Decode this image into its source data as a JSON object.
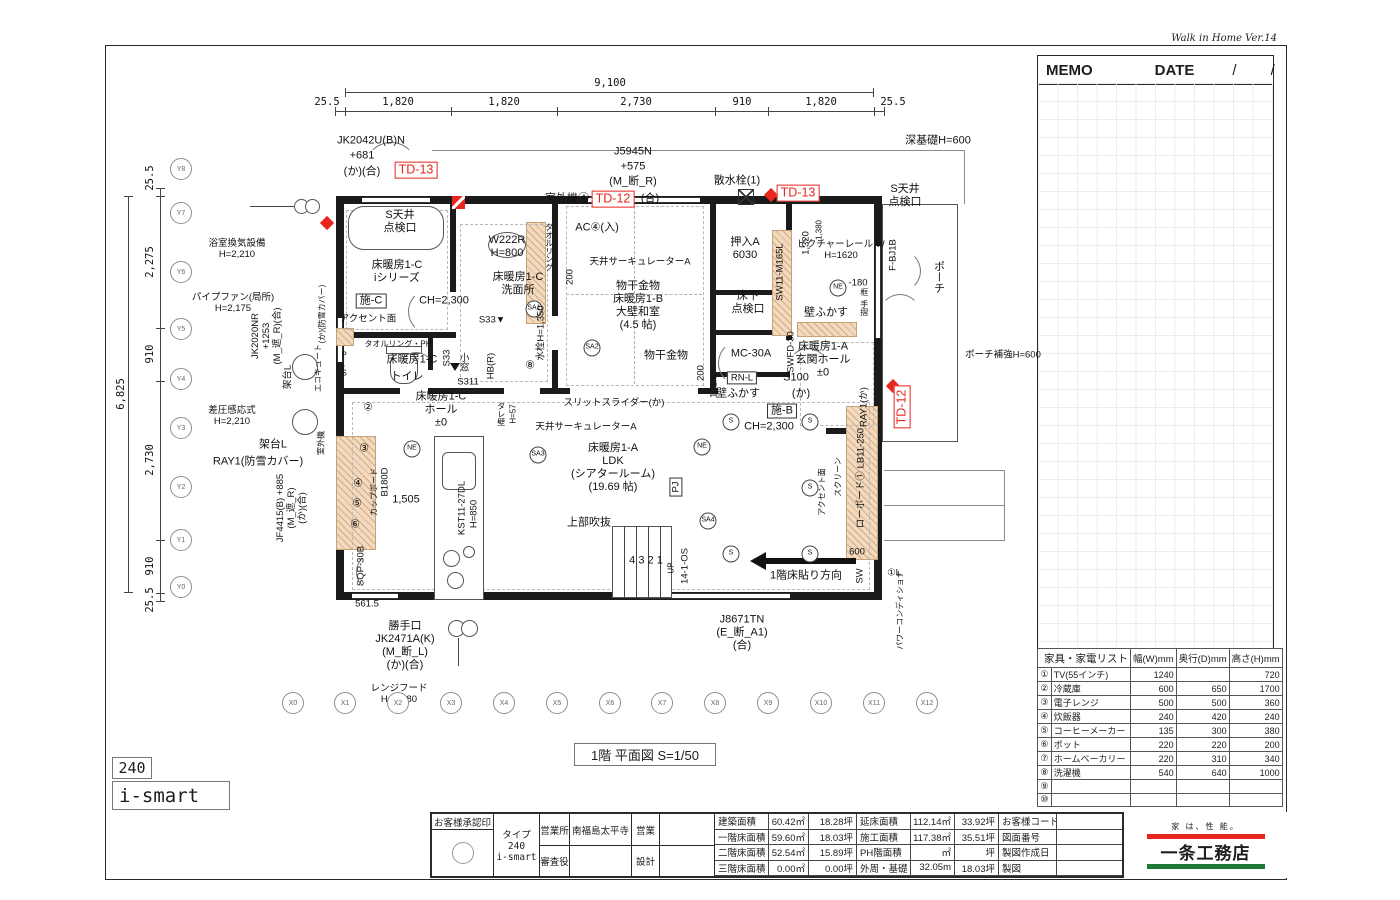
{
  "app": {
    "version_label": "Walk in Home Ver.14"
  },
  "memo": {
    "memo_label": "MEMO",
    "date_label": "DATE",
    "slash1": "/",
    "slash2": "/"
  },
  "plan": {
    "title": "1階  平面図 S=1/50",
    "type_badge": "240",
    "model_badge": "i-smart",
    "annotations": [
      [
        "JK2042U(B)N",
        371,
        141,
        ""
      ],
      [
        "+681",
        362,
        156,
        ""
      ],
      [
        "(か)(合)",
        362,
        172,
        ""
      ],
      [
        "TD-13",
        416,
        170,
        "red box"
      ],
      [
        "室外機④",
        567,
        199,
        ""
      ],
      [
        "TD-12",
        613,
        199,
        "red box"
      ],
      [
        "(合)",
        650,
        199,
        ""
      ],
      [
        "J5945N",
        633,
        152,
        ""
      ],
      [
        "+575",
        633,
        167,
        ""
      ],
      [
        "(M_断_R)",
        633,
        182,
        ""
      ],
      [
        "散水栓(1)",
        737,
        181,
        ""
      ],
      [
        "TD-13",
        798,
        193,
        "red box"
      ],
      [
        "S天井\n点検口",
        905,
        196,
        ""
      ],
      [
        "深基礎H=600",
        938,
        141,
        ""
      ],
      [
        "浴室換気設備\nH=2,210",
        237,
        249,
        "sm"
      ],
      [
        "パイプファン(局所)\nH=2,175",
        233,
        303,
        "sm"
      ],
      [
        "JK2020NR\n+1253\n(M_遮_R)(合)",
        267,
        336,
        "rot sm"
      ],
      [
        "(か)(防雪カバー)",
        322,
        314,
        "rot tiny"
      ],
      [
        "エコキュート",
        318,
        368,
        "rot tiny"
      ],
      [
        "架台L",
        288,
        377,
        "rot sm"
      ],
      [
        "差圧感応式\nH=2,210",
        232,
        416,
        "sm"
      ],
      [
        "架台L",
        273,
        445,
        ""
      ],
      [
        "室外機",
        321,
        443,
        "rot tiny"
      ],
      [
        "RAY1(防雪カバー)",
        258,
        462,
        ""
      ],
      [
        "JF4415(B) +885\n(M_遮_R)\n(か)(合)",
        292,
        508,
        "rot sm"
      ],
      [
        "S天井\n点検口",
        400,
        222,
        ""
      ],
      [
        "床暖房1-C\niシリーズ",
        397,
        272,
        ""
      ],
      [
        "施-C",
        371,
        301,
        "box"
      ],
      [
        "アクセント面",
        368,
        319,
        "sm"
      ],
      [
        "CH=2,300",
        444,
        301,
        ""
      ],
      [
        "W222R\nH=800",
        507,
        247,
        ""
      ],
      [
        "タオルリング",
        549,
        247,
        "vert tiny"
      ],
      [
        "床暖房1-C\n洗面所",
        518,
        284,
        ""
      ],
      [
        "SA1",
        534,
        309,
        "circ"
      ],
      [
        "S33▼",
        492,
        320,
        "sm"
      ],
      [
        "水栓H=1,350",
        541,
        333,
        "rot sm"
      ],
      [
        "⑧",
        530,
        366,
        ""
      ],
      [
        "タオルリング・PH",
        398,
        344,
        "tiny"
      ],
      [
        "P.S",
        344,
        364,
        "vert tiny"
      ],
      [
        "床暖房1-C",
        412,
        360,
        ""
      ],
      [
        "トイレ",
        407,
        377,
        ""
      ],
      [
        "S33",
        447,
        358,
        "rot sm"
      ],
      [
        "小窓",
        463,
        362,
        "vert sm"
      ],
      [
        "S311",
        468,
        382,
        "sm"
      ],
      [
        "HB(R)",
        491,
        366,
        "rot sm"
      ],
      [
        "AC④(入)",
        597,
        228,
        ""
      ],
      [
        "天井サーキュレーターA",
        640,
        262,
        "sm"
      ],
      [
        "200",
        570,
        277,
        "rot sm"
      ],
      [
        "物干金物\n床暖房1-B\n大壁和室\n(4.5 帖)",
        638,
        306,
        ""
      ],
      [
        "SA2",
        592,
        348,
        "circ"
      ],
      [
        "物干金物",
        666,
        356,
        ""
      ],
      [
        "200",
        701,
        373,
        "rot sm"
      ],
      [
        "押入A\n6030",
        745,
        249,
        ""
      ],
      [
        "床下\n点検口",
        748,
        303,
        ""
      ],
      [
        "SW11-M165L",
        780,
        272,
        "rot sm"
      ],
      [
        "MC-30A",
        751,
        354,
        ""
      ],
      [
        "1,320",
        806,
        243,
        "rot sm"
      ],
      [
        "1,380",
        819,
        230,
        "rot tiny"
      ],
      [
        "ピクチャーレール W\nH=1620",
        841,
        250,
        "sm"
      ],
      [
        "NE",
        838,
        288,
        "circ"
      ],
      [
        "-180",
        858,
        283,
        "sm"
      ],
      [
        "框",
        864,
        292,
        "vert tiny"
      ],
      [
        "手摺",
        864,
        308,
        "vert tiny"
      ],
      [
        "壁ふかす",
        826,
        313,
        ""
      ],
      [
        "床暖房1-A\n玄関ホール\n±0",
        823,
        360,
        ""
      ],
      [
        "SWFD-30",
        791,
        352,
        "rot sm"
      ],
      [
        "F-BJ1B",
        893,
        255,
        "rot sm"
      ],
      [
        "ポーチ",
        938,
        277,
        "vert"
      ],
      [
        "ポーチ補強H=600",
        1003,
        355,
        "sm"
      ],
      [
        "RN-L",
        742,
        378,
        "box sm"
      ],
      [
        "壁ふかす",
        738,
        394,
        ""
      ],
      [
        "101.5",
        714,
        386,
        "rot sm"
      ],
      [
        "S100",
        796,
        378,
        ""
      ],
      [
        "(か)",
        801,
        394,
        ""
      ],
      [
        "施-B",
        782,
        411,
        "box"
      ],
      [
        "CH=2,300",
        769,
        427,
        ""
      ],
      [
        "スリットスライダー(か)",
        614,
        403,
        "sm"
      ],
      [
        "天井サーキュレーターA",
        586,
        427,
        "sm"
      ],
      [
        "床暖房1-A\nLDK\n(シアタールーム)\n(19.69 帖)",
        613,
        468,
        ""
      ],
      [
        "PJ",
        676,
        487,
        "box rot sm"
      ],
      [
        "NE",
        702,
        447,
        "circ"
      ],
      [
        "SA3",
        538,
        455,
        "circ"
      ],
      [
        "SA4",
        708,
        521,
        "circ"
      ],
      [
        "S",
        731,
        422,
        "circ"
      ],
      [
        "S",
        810,
        422,
        "circ"
      ],
      [
        "S",
        810,
        488,
        "circ"
      ],
      [
        "S",
        731,
        554,
        "circ"
      ],
      [
        "S",
        810,
        554,
        "circ"
      ],
      [
        "上部吹抜",
        589,
        523,
        ""
      ],
      [
        "4 3 2 1",
        646,
        561,
        ""
      ],
      [
        "UP",
        671,
        568,
        "rot tiny"
      ],
      [
        "14-1-OS",
        685,
        566,
        "rot sm"
      ],
      [
        "1階床貼り方向",
        806,
        576,
        ""
      ],
      [
        "床暖房1-C\nホール\n±0",
        441,
        410,
        ""
      ],
      [
        "②",
        368,
        408,
        ""
      ],
      [
        "③",
        364,
        449,
        ""
      ],
      [
        "④",
        358,
        484,
        ""
      ],
      [
        "⑤",
        357,
        504,
        ""
      ],
      [
        "⑥",
        355,
        525,
        ""
      ],
      [
        "カップボード",
        374,
        492,
        "rot tiny"
      ],
      [
        "B180D",
        385,
        482,
        "rot sm"
      ],
      [
        "1,505",
        406,
        500,
        ""
      ],
      [
        "NE",
        412,
        449,
        "circ"
      ],
      [
        "KST11-27DL",
        462,
        508,
        "rot sm"
      ],
      [
        "H=850",
        474,
        514,
        "rot sm"
      ],
      [
        "タレ壁",
        501,
        414,
        "vert tiny"
      ],
      [
        "H=57",
        513,
        414,
        "rot tiny"
      ],
      [
        "SQP-30B",
        361,
        566,
        "rot sm"
      ],
      [
        "561.5",
        367,
        604,
        "sm"
      ],
      [
        "RAY1(か)",
        864,
        407,
        "rot sm"
      ],
      [
        "スクリーン",
        838,
        477,
        "rot tiny"
      ],
      [
        "アクセント面",
        822,
        492,
        "rot tiny"
      ],
      [
        "ローボード① LB11-250",
        861,
        478,
        "rot sm"
      ],
      [
        "600",
        857,
        552,
        "sm"
      ],
      [
        "SW",
        860,
        576,
        "rot sm"
      ],
      [
        "TD-12",
        902,
        407,
        "red box rot"
      ],
      [
        "①L",
        894,
        573,
        "sm"
      ],
      [
        "パワーコンディショナ",
        900,
        610,
        "rot tiny"
      ],
      [
        "勝手口\nJK2471A(K)\n(M_断_L)\n(か)(合)",
        405,
        646,
        ""
      ],
      [
        "レンジフード\nH=2,280",
        399,
        694,
        "sm"
      ],
      [
        "J8671TN\n(E_断_A1)\n(合)",
        742,
        633,
        ""
      ]
    ],
    "grid": {
      "x_row_y": 703,
      "x": [
        [
          "X0",
          293
        ],
        [
          "X1",
          345
        ],
        [
          "X2",
          398
        ],
        [
          "X3",
          451
        ],
        [
          "X4",
          504
        ],
        [
          "X5",
          557
        ],
        [
          "X6",
          610
        ],
        [
          "X7",
          662
        ],
        [
          "X8",
          715
        ],
        [
          "X9",
          768
        ],
        [
          "X10",
          821
        ],
        [
          "X11",
          874
        ],
        [
          "X12",
          927
        ]
      ],
      "y_col_x": 181,
      "y": [
        [
          "Y8",
          169
        ],
        [
          "Y7",
          213
        ],
        [
          "Y6",
          272
        ],
        [
          "Y5",
          329
        ],
        [
          "Y4",
          379
        ],
        [
          "Y3",
          428
        ],
        [
          "Y2",
          487
        ],
        [
          "Y1",
          540
        ],
        [
          "Y0",
          587
        ]
      ]
    },
    "dims": {
      "top_total": "9,100",
      "top_ticks": [
        335,
        345,
        451,
        557,
        715,
        768,
        874,
        884
      ],
      "top_labels": [
        [
          "25.5",
          327
        ],
        [
          "1,820",
          398
        ],
        [
          "1,820",
          504
        ],
        [
          "2,730",
          636
        ],
        [
          "910",
          742
        ],
        [
          "1,820",
          821
        ],
        [
          "25.5",
          893
        ]
      ],
      "left_total": "6,825",
      "left_ticks": [
        188,
        196,
        328,
        381,
        540,
        593,
        601
      ],
      "left_labels": [
        [
          "25.5",
          178
        ],
        [
          "2,275",
          262
        ],
        [
          "910",
          354
        ],
        [
          "2,730",
          460
        ],
        [
          "910",
          566
        ],
        [
          "25.5",
          600
        ]
      ]
    }
  },
  "furniture": {
    "title": "家具・家電リスト",
    "cols": [
      "幅(W)mm",
      "奥行(D)mm",
      "高さ(H)mm"
    ],
    "rows": [
      [
        "①",
        "TV(55インチ)",
        "1240",
        "",
        "720"
      ],
      [
        "②",
        "冷蔵庫",
        "600",
        "650",
        "1700"
      ],
      [
        "③",
        "電子レンジ",
        "500",
        "500",
        "360"
      ],
      [
        "④",
        "炊飯器",
        "240",
        "420",
        "240"
      ],
      [
        "⑤",
        "コーヒーメーカー",
        "135",
        "300",
        "380"
      ],
      [
        "⑥",
        "ポット",
        "220",
        "220",
        "200"
      ],
      [
        "⑦",
        "ホームベーカリー",
        "220",
        "310",
        "340"
      ],
      [
        "⑧",
        "洗濯機",
        "540",
        "640",
        "1000"
      ],
      [
        "⑨",
        "",
        "",
        "",
        ""
      ],
      [
        "⑩",
        "",
        "",
        "",
        ""
      ]
    ]
  },
  "title_block": {
    "approval_label": "お客様承認印",
    "type_label": "タイプ",
    "type_value": "240",
    "model_value": "i-smart",
    "office_label": "営業所",
    "office_value": "南福島太平寺",
    "examiner_label": "審査役",
    "examiner_value": "",
    "sales_label": "営業",
    "sales_value": "",
    "design_label": "設計",
    "design_value": "",
    "areas_a": [
      [
        "建築面積",
        "60.42㎡",
        "18.28坪"
      ],
      [
        "一階床面積",
        "59.60㎡",
        "18.03坪"
      ],
      [
        "二階床面積",
        "52.54㎡",
        "15.89坪"
      ],
      [
        "三階床面積",
        "0.00㎡",
        "0.00坪"
      ]
    ],
    "areas_b": [
      [
        "延床面積",
        "112.14㎡",
        "33.92坪"
      ],
      [
        "施工面積",
        "117.38㎡",
        "35.51坪"
      ],
      [
        "PH階面積",
        "㎡",
        "坪"
      ],
      [
        "外周・基礎",
        "32.05m",
        "18.03坪"
      ]
    ],
    "right_labels": [
      "お客様コード",
      "図面番号",
      "製図作成日",
      "製図"
    ]
  },
  "logo": {
    "slogan": "家 は、性 能。",
    "name": "一条工務店"
  }
}
